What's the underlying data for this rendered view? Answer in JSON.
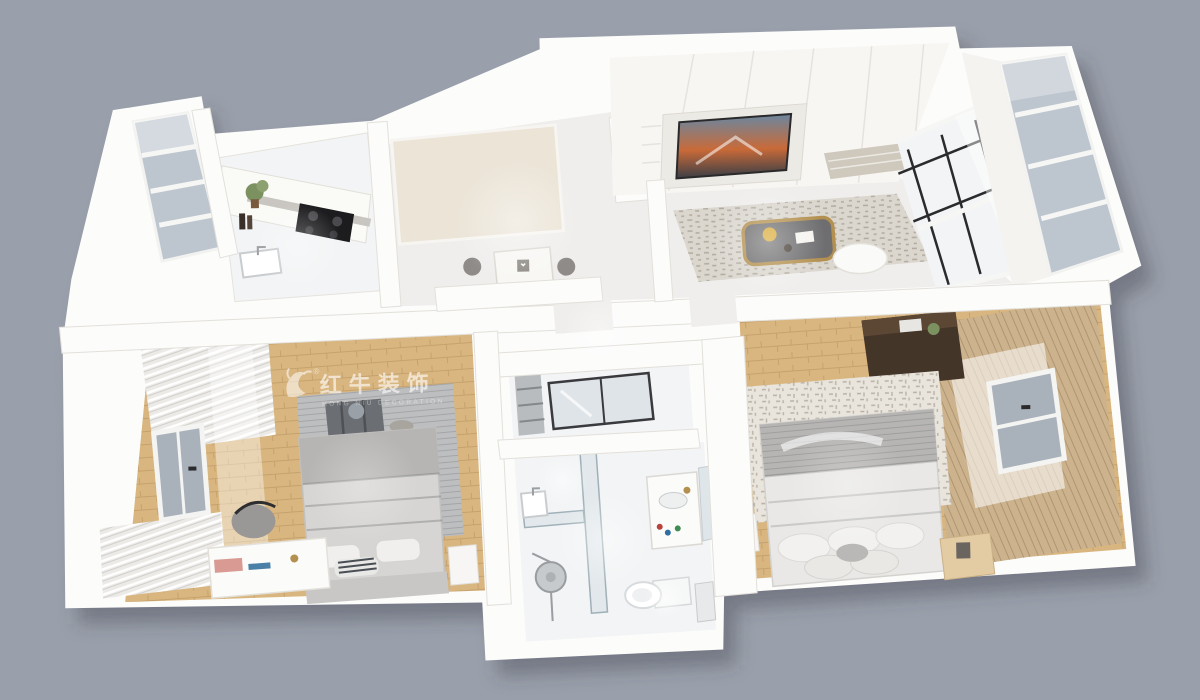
{
  "scene": {
    "type": "3d-floorplan-render",
    "background_color": "#9aa0ab",
    "watermark": {
      "brand": "红牛装饰",
      "subtext": "HONG NIU DECORATION",
      "registered_mark": "®",
      "logo": "bull-logo"
    },
    "colors": {
      "wall": "#fcfcfb",
      "cream": "#ebe4d7",
      "floor": "#efeeec",
      "tile": "#f2f4f5",
      "wood": "#d9b67f",
      "glass_balcony": "#bdc6cf",
      "glass_window": "#a9b1ba",
      "frame_black": "#2b2b2e",
      "rug_gray": "#bdbebf",
      "rug_beige": "#e9e5dc",
      "rug_living": "#dbd7cf",
      "bed_gray": "#b6b5b3",
      "bed_light": "#d6d5d3",
      "duvet_white": "#e9e8e6",
      "gold": "#b3904f",
      "walnut": "#443529",
      "curtain_tan": "#ccb38e",
      "cooktop": "#1c1c1e",
      "book_pink": "#d89a93",
      "chair_gray": "#8f8b88",
      "tv_sky": "#6b87a0",
      "tv_mountain": "#c96a38",
      "plant_green": "#7c9160",
      "luggage_gray": "#6b6e73"
    },
    "rooms": [
      {
        "id": "balcony-left",
        "features": [
          "glazed-windows",
          "plant"
        ]
      },
      {
        "id": "kitchen",
        "features": [
          "counter",
          "gas-cooktop",
          "sink",
          "plant",
          "bottles"
        ]
      },
      {
        "id": "entry-dining",
        "features": [
          "dining-table",
          "two-chairs",
          "wardrobe",
          "bulkhead"
        ]
      },
      {
        "id": "living-room",
        "features": [
          "media-wall",
          "tv",
          "area-rug",
          "coffee-table",
          "ottoman",
          "window-wall"
        ]
      },
      {
        "id": "balcony-right",
        "features": [
          "glazed-windows"
        ]
      },
      {
        "id": "bedroom-left",
        "features": [
          "bed",
          "rug",
          "luggage",
          "blinds",
          "window",
          "desk",
          "chair",
          "nightstand",
          "pink-book"
        ]
      },
      {
        "id": "utility-room",
        "features": [
          "glass-partition",
          "shelving"
        ]
      },
      {
        "id": "bathroom",
        "features": [
          "shower",
          "rain-showerhead",
          "vanity",
          "sink",
          "toilet",
          "mirror",
          "cabinet"
        ]
      },
      {
        "id": "bedroom-right",
        "features": [
          "bed",
          "pillows",
          "rug",
          "walnut-dresser",
          "curtains",
          "window",
          "nightstands"
        ]
      }
    ]
  }
}
